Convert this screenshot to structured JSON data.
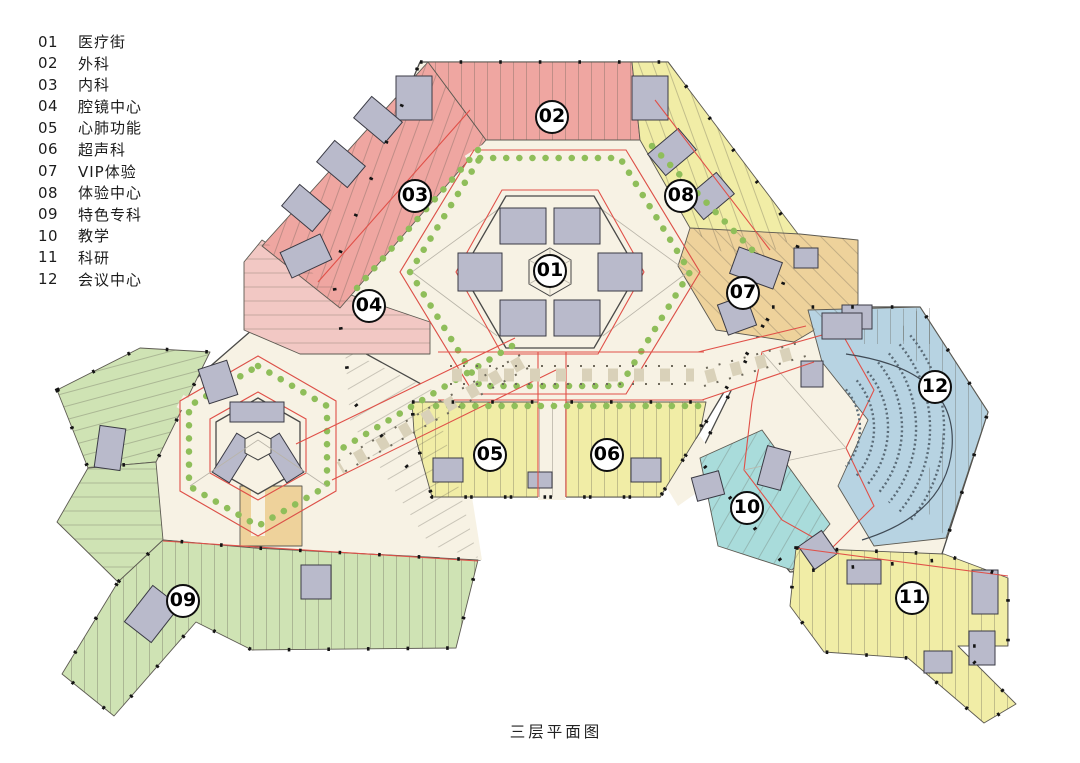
{
  "caption": "三层平面图",
  "legend": {
    "items": [
      {
        "num": "01",
        "label": "医疗街"
      },
      {
        "num": "02",
        "label": "外科"
      },
      {
        "num": "03",
        "label": "内科"
      },
      {
        "num": "04",
        "label": "腔镜中心"
      },
      {
        "num": "05",
        "label": "心肺功能"
      },
      {
        "num": "06",
        "label": "超声科"
      },
      {
        "num": "07",
        "label": "VIP体验"
      },
      {
        "num": "08",
        "label": "体验中心"
      },
      {
        "num": "09",
        "label": "特色专科"
      },
      {
        "num": "10",
        "label": "教学"
      },
      {
        "num": "11",
        "label": "科研"
      },
      {
        "num": "12",
        "label": "会议中心"
      }
    ]
  },
  "plan": {
    "badges": [
      {
        "num": "01",
        "label": "医疗街",
        "x": 550,
        "y": 271
      },
      {
        "num": "02",
        "label": "外科",
        "x": 552,
        "y": 117
      },
      {
        "num": "03",
        "label": "内科",
        "x": 415,
        "y": 196
      },
      {
        "num": "04",
        "label": "腔镜中心",
        "x": 369,
        "y": 306
      },
      {
        "num": "05",
        "label": "心肺功能",
        "x": 490,
        "y": 455
      },
      {
        "num": "06",
        "label": "超声科",
        "x": 607,
        "y": 455
      },
      {
        "num": "07",
        "label": "VIP体验",
        "x": 743,
        "y": 293
      },
      {
        "num": "08",
        "label": "体验中心",
        "x": 681,
        "y": 196
      },
      {
        "num": "09",
        "label": "特色专科",
        "x": 183,
        "y": 601
      },
      {
        "num": "10",
        "label": "教学",
        "x": 747,
        "y": 508
      },
      {
        "num": "11",
        "label": "科研",
        "x": 912,
        "y": 598
      },
      {
        "num": "12",
        "label": "会议中心",
        "x": 935,
        "y": 387
      }
    ],
    "zones": [
      {
        "num": "01",
        "label": "医疗街",
        "color": "cream"
      },
      {
        "num": "02",
        "label": "外科",
        "color": "pink"
      },
      {
        "num": "03",
        "label": "内科",
        "color": "pink"
      },
      {
        "num": "04",
        "label": "腔镜中心",
        "color": "pink-light"
      },
      {
        "num": "05",
        "label": "心肺功能",
        "color": "yellow"
      },
      {
        "num": "06",
        "label": "超声科",
        "color": "yellow"
      },
      {
        "num": "07",
        "label": "VIP体验",
        "color": "tan"
      },
      {
        "num": "08",
        "label": "体验中心",
        "color": "yellow"
      },
      {
        "num": "09",
        "label": "特色专科",
        "color": "green"
      },
      {
        "num": "10",
        "label": "教学",
        "color": "cyan"
      },
      {
        "num": "11",
        "label": "科研",
        "color": "yellow"
      },
      {
        "num": "12",
        "label": "会议中心",
        "color": "blue"
      }
    ],
    "colors": {
      "pink": "#efa6a1",
      "pink-light": "#f2c8c4",
      "yellow": "#f1eda6",
      "tan": "#eed29b",
      "green": "#cfe3b4",
      "cyan": "#a9dcdb",
      "blue": "#b7d3e2",
      "cream": "#f7f2e4",
      "white": "#ffffff",
      "core": "#b9bacb",
      "outline": "#4a4a48",
      "red": "#e05048",
      "plant": "#8fbe5a",
      "seat": "#5a6b77",
      "dot": "#141414"
    }
  }
}
